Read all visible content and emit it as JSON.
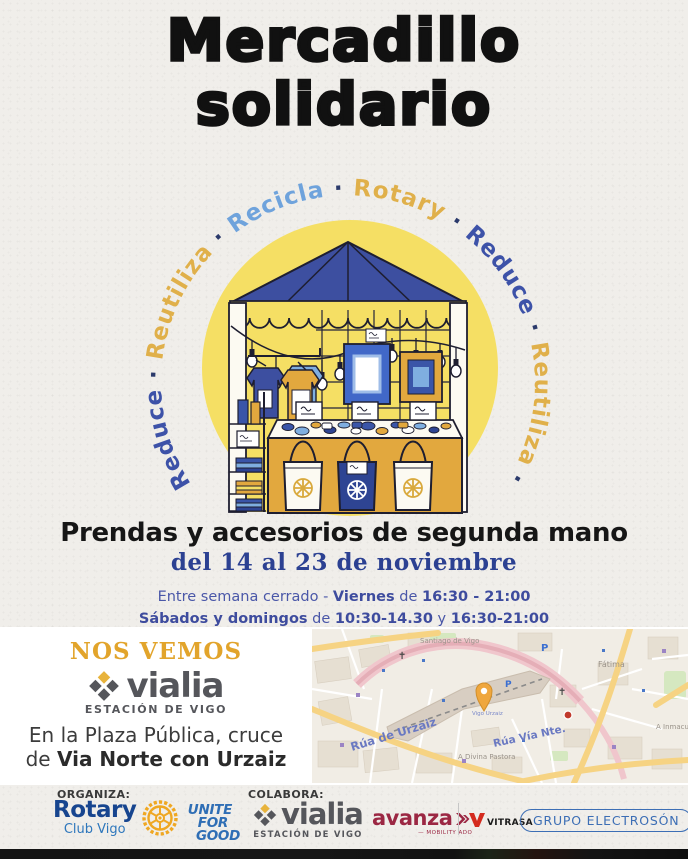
{
  "title": {
    "line1": "Mercadillo",
    "line2": "solidario"
  },
  "ring": {
    "separator": "·",
    "separator_color": "#2B3A6B",
    "words": [
      {
        "text": "Reduce",
        "color": "#3D52A8"
      },
      {
        "text": "Reutiliza",
        "color": "#E0B04A"
      },
      {
        "text": "Recicla",
        "color": "#6FA3DC"
      },
      {
        "text": "Rotary",
        "color": "#E0B04A"
      },
      {
        "text": "Reduce",
        "color": "#3D52A8"
      },
      {
        "text": "Reutiliza",
        "color": "#E0B04A"
      },
      {
        "text": "Recicla",
        "color": "#6FA3DC"
      },
      {
        "text": "Rotary",
        "color": "#E0B04A"
      }
    ]
  },
  "subtitle": "Prendas y accesorios de segunda mano",
  "date_range": "del 14 al 23 de noviembre",
  "schedule": [
    {
      "parts": [
        {
          "text": "Entre semana cerrado - ",
          "bold": false
        },
        {
          "text": "Viernes",
          "bold": true
        },
        {
          "text": " de ",
          "bold": false
        },
        {
          "text": "16:30 - 21:00",
          "bold": true
        }
      ]
    },
    {
      "parts": [
        {
          "text": "Sábados y domingos",
          "bold": true
        },
        {
          "text": " de ",
          "bold": false
        },
        {
          "text": "10:30-14.30",
          "bold": true
        },
        {
          "text": " y ",
          "bold": false
        },
        {
          "text": "16:30-21:00",
          "bold": true
        }
      ]
    }
  ],
  "venue": {
    "headline": "NOS VEMOS",
    "vialia_name": "vialia",
    "vialia_sub": "ESTACIÓN DE VIGO",
    "address_line1": "En la Plaza Pública, cruce",
    "address_line2_prefix": "de ",
    "address_line2_bold": "Via Norte con Urzaiz"
  },
  "map": {
    "pin_color": "#EFA73E",
    "labels": {
      "santiago": "Santiago de Vigo",
      "fatima": "Fátima",
      "urzaiz": "Rúa de Urzaiz",
      "via_norte": "Rúa Vía Nte.",
      "divina": "A Divina Pastora",
      "inmaculada": "A Inmacula",
      "station": "Vigo Urzaiz",
      "parking": "P"
    }
  },
  "footer": {
    "organiza_label": "ORGANIZA:",
    "colabora_label": "COLABORA:",
    "rotary_name": "Rotary",
    "rotary_sub": "Club Vigo",
    "unite": [
      "UNITE",
      "FOR",
      "GOOD"
    ],
    "vialia_name": "vialia",
    "vialia_sub": "ESTACIÓN DE VIGO",
    "avanza_name": "avanza",
    "avanza_sub": "— MOBILITY ADO",
    "vitrasa": "VITRASA",
    "electroson": "GRUPO ELECTROSÓN"
  }
}
